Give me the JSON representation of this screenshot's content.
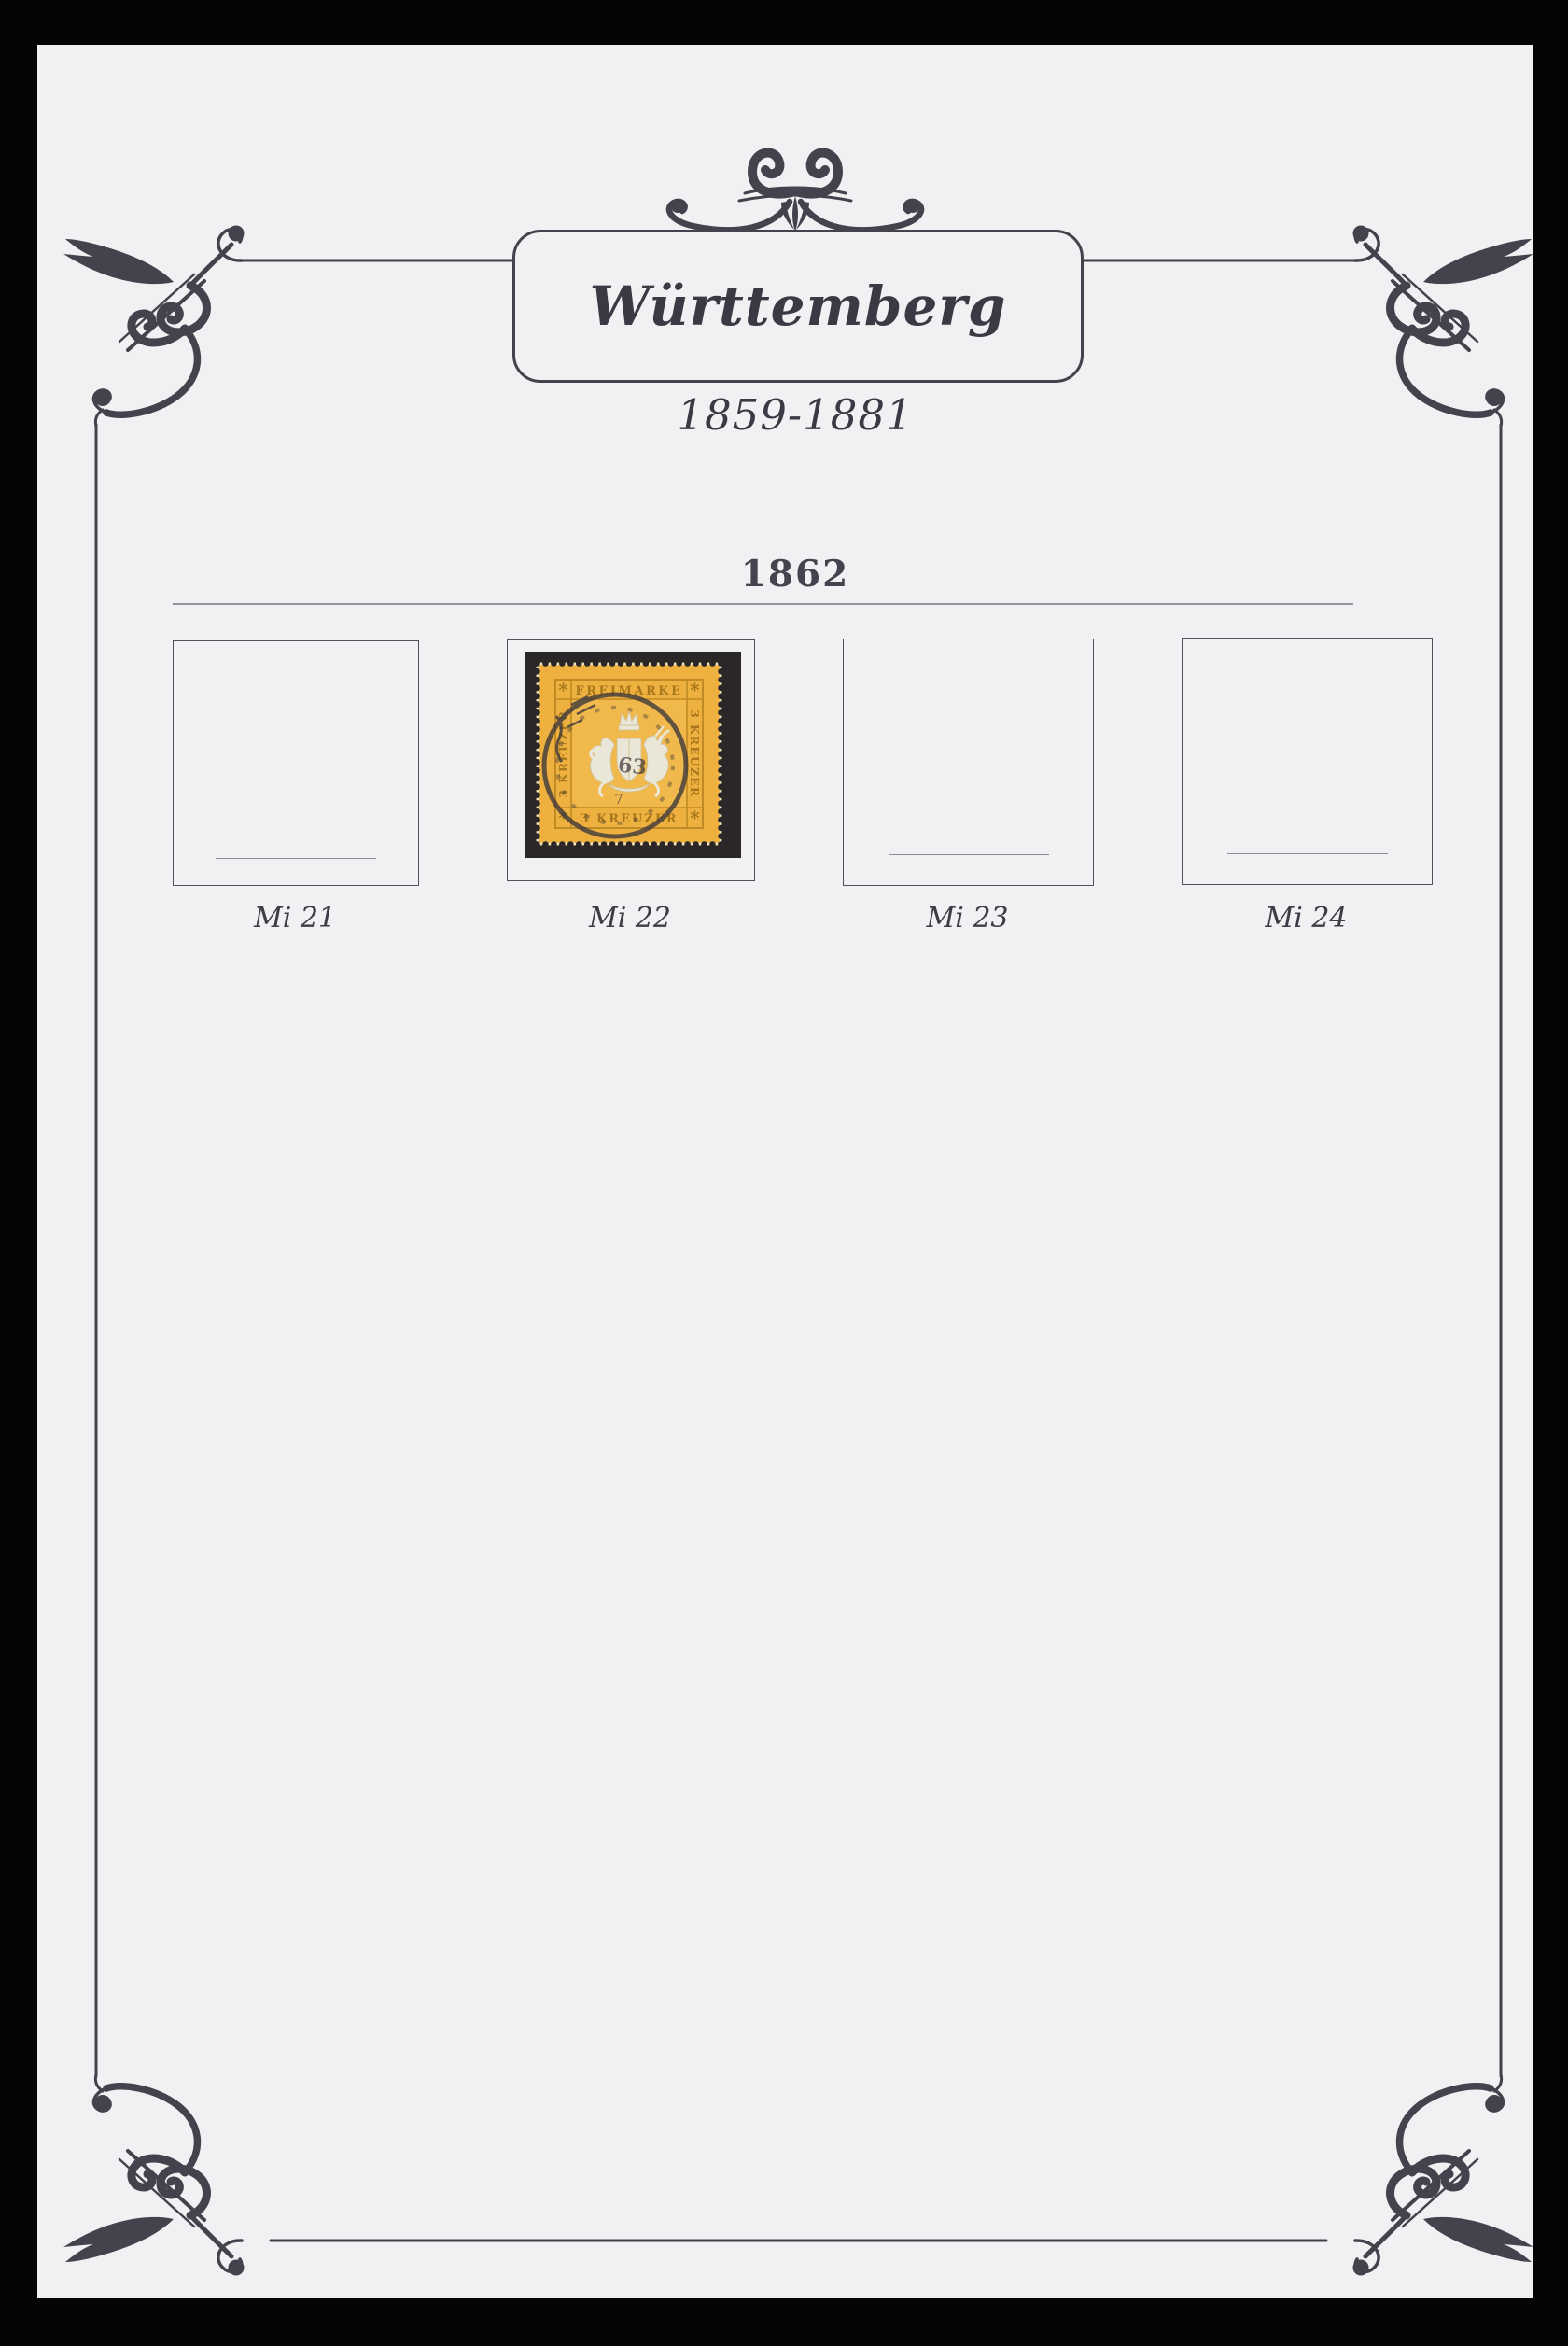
{
  "album_page": {
    "title": "Württemberg",
    "subtitle": "1859-1881",
    "section_year": "1862",
    "slots": [
      {
        "label": "Mi 21",
        "has_stamp": false
      },
      {
        "label": "Mi 22",
        "has_stamp": true
      },
      {
        "label": "Mi 23",
        "has_stamp": false
      },
      {
        "label": "Mi 24",
        "has_stamp": false
      }
    ]
  },
  "stamp": {
    "top_inscription": "FREIMARKE",
    "bottom_inscription": "3 KREUZER",
    "left_inscription": "3 KREUZER",
    "right_inscription": "3 KREUZER",
    "corner_marks": "*",
    "postmark": {
      "number": "63",
      "digit": "7"
    }
  },
  "colors": {
    "surround_black": "#060505",
    "page_background": "#f1f0f2",
    "frame_ink": "#44424c",
    "box_border": "#54515b",
    "rule_gray": "#94929b",
    "stamp_yellow": "#eeb13f",
    "stamp_frame_gold": "#c08a25",
    "stamp_lettering": "#a8771c",
    "arms_pale": "#eae6d8",
    "mount_black": "#2b2627",
    "postmark_ink": "#3a373c"
  }
}
